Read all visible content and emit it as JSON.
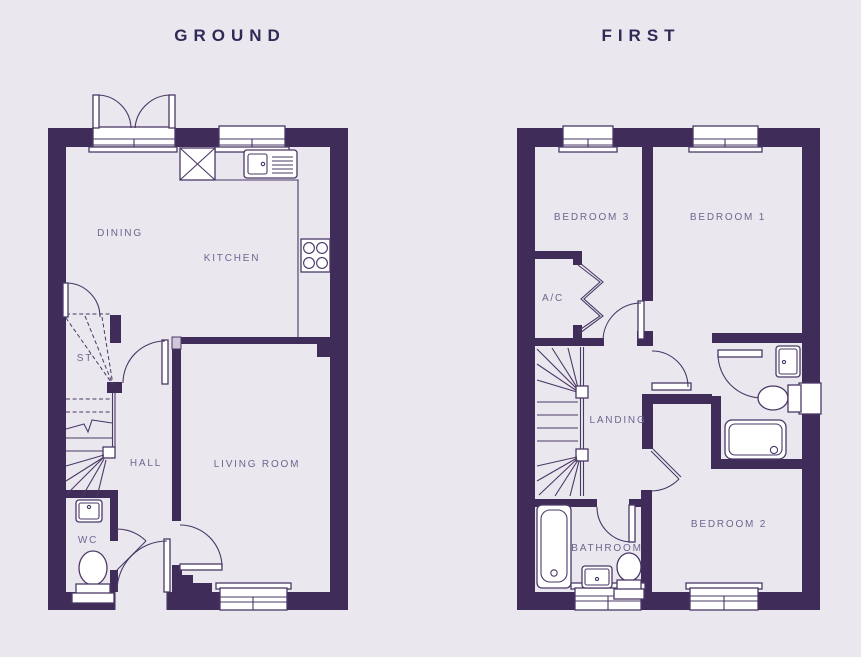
{
  "page": {
    "background_color": "#eae8ee",
    "wall_color": "#3f2c59",
    "line_color": "#4a3867",
    "title_color": "#322a56",
    "label_color": "#6f6590"
  },
  "floors": [
    {
      "title": "GROUND",
      "rooms": [
        {
          "label": "DINING"
        },
        {
          "label": "KITCHEN"
        },
        {
          "label": "ST"
        },
        {
          "label": "HALL"
        },
        {
          "label": "LIVING ROOM"
        },
        {
          "label": "WC"
        }
      ],
      "fixtures": [
        "french-doors",
        "kitchen-window",
        "appliance-space",
        "sink-with-drainer",
        "worktop",
        "hob",
        "stairs",
        "wc-basin",
        "wc-toilet",
        "living-room-window",
        "front-door"
      ]
    },
    {
      "title": "FIRST",
      "rooms": [
        {
          "label": "BEDROOM 3"
        },
        {
          "label": "BEDROOM 1"
        },
        {
          "label": "A/C"
        },
        {
          "label": "LANDING"
        },
        {
          "label": "BATHROOM"
        },
        {
          "label": "BEDROOM 2"
        }
      ],
      "fixtures": [
        "bedroom3-window",
        "bedroom1-window",
        "airing-cupboard-bifold",
        "stairs",
        "bath",
        "bathroom-basin",
        "bathroom-toilet",
        "ensuite-basin",
        "ensuite-toilet",
        "shower",
        "bathroom-window",
        "bedroom2-window",
        "ensuite-window"
      ]
    }
  ]
}
